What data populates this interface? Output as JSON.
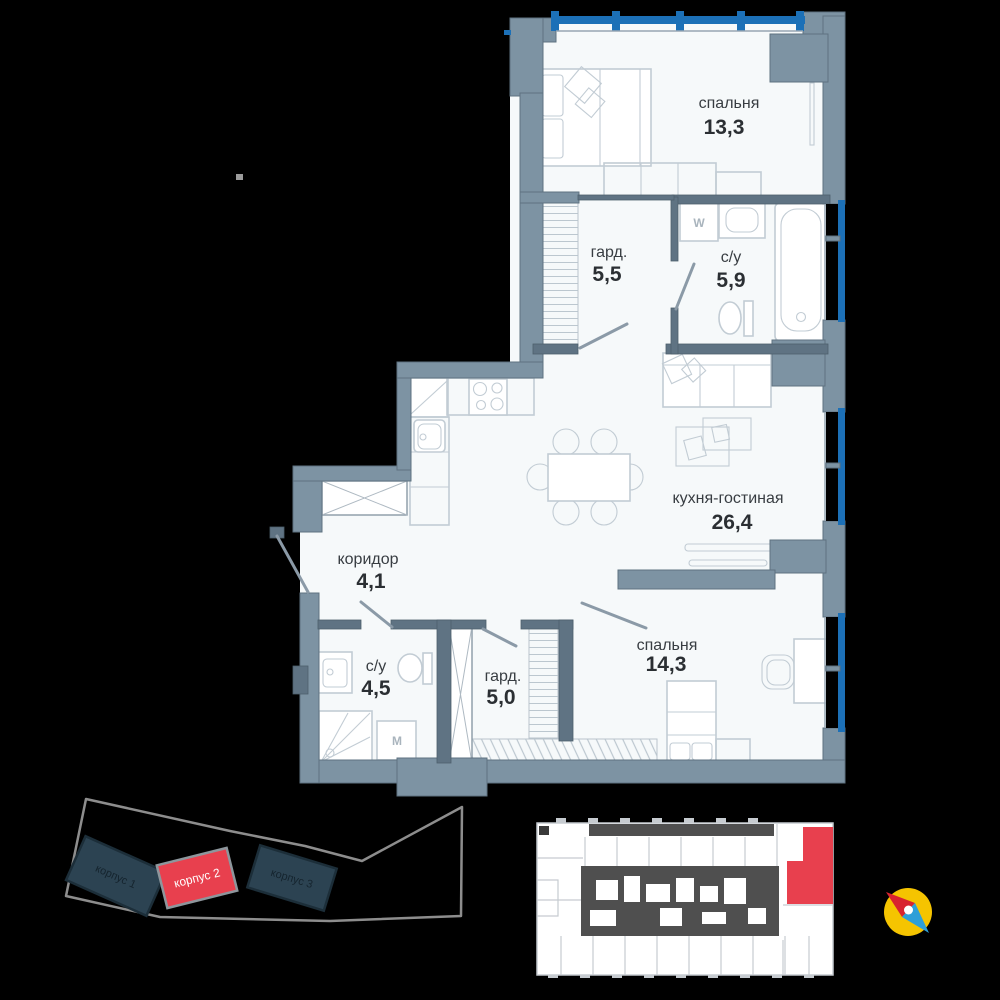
{
  "floorplan": {
    "rooms": [
      {
        "id": "bedroom-top",
        "name": "спальня",
        "area": "13,3"
      },
      {
        "id": "wardrobe-top",
        "name": "гард.",
        "area": "5,5"
      },
      {
        "id": "bathroom-top",
        "name": "с/у",
        "area": "5,9"
      },
      {
        "id": "kitchen-living",
        "name": "кухня-гостиная",
        "area": "26,4"
      },
      {
        "id": "corridor",
        "name": "коридор",
        "area": "4,1"
      },
      {
        "id": "bathroom-bottom",
        "name": "с/у",
        "area": "4,5"
      },
      {
        "id": "wardrobe-bottom",
        "name": "гард.",
        "area": "5,0"
      },
      {
        "id": "bedroom-bottom",
        "name": "спальня",
        "area": "14,3"
      }
    ],
    "appliances": {
      "washer": "W",
      "washing_machine": "M"
    }
  },
  "site_plan": {
    "buildings": [
      {
        "label": "корпус 1",
        "highlighted": false
      },
      {
        "label": "корпус 2",
        "highlighted": true
      },
      {
        "label": "корпус 3",
        "highlighted": false
      }
    ]
  },
  "floor_plate": {
    "selected_unit": "top-right"
  },
  "colors": {
    "background": "#000000",
    "floor": "#f6f9fa",
    "wall": "#7d93a3",
    "wall-dark": "#5f7383",
    "window": "#1c70b7",
    "furniture": "#c2ccd4",
    "highlight": "#e8404e",
    "compass": "#f5c400",
    "label": "#383d42",
    "site-building": "#2c4352",
    "site-outline": "#8d8d8d"
  }
}
